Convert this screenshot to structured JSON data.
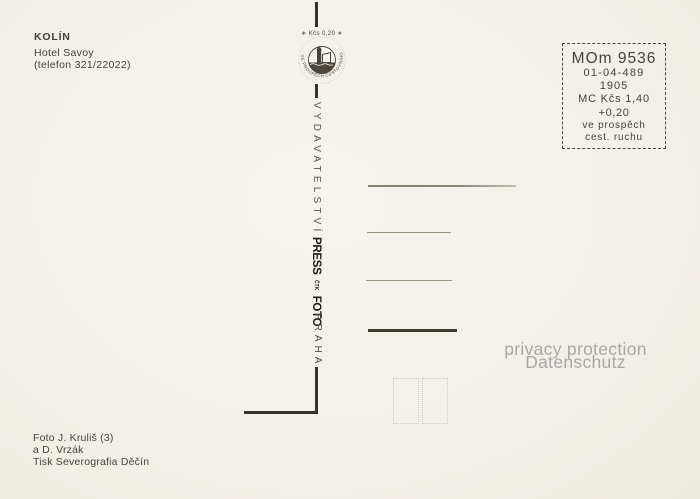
{
  "card": {
    "title_block": {
      "city": "KOLÍN",
      "venue": "Hotel Savoy",
      "phone": "(telefon 321/22022)"
    },
    "emblem": {
      "price": "∗ Kčs 0,20 ∗",
      "ring_text": "VE PROSPĚCH CESTOVNÍHO RUCHU"
    },
    "spine": {
      "publisher": "VYDAVATELSTVÍ",
      "logo_press": "PRESS",
      "logo_ctk": "ČTK",
      "logo_foto": "FOTO",
      "city": "PRAHA"
    },
    "stamp_box": {
      "code": "MOm 9536",
      "number": "01-04-489",
      "year": "1905",
      "price_line1": "MC Kčs 1,40",
      "price_line2": "+0,20",
      "note_line1": "ve prospěch",
      "note_line2": "cest. ruchu"
    },
    "watermark": {
      "line1": "privacy protection",
      "line2": "Datenschutz"
    },
    "credits": {
      "photo": "Foto J. Kruliš (3)",
      "photo2": "a D. Vrzák",
      "print": "Tisk Severografia Děčín"
    },
    "colors": {
      "paper": "#f4f1ea",
      "ink": "#3a3732",
      "divider": "#35332d",
      "watermark_gray": "#a8a7a5"
    }
  }
}
